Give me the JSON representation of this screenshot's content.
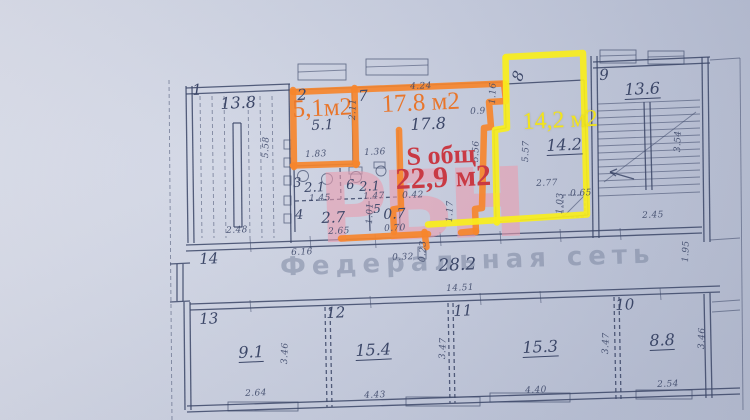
{
  "document": {
    "type": "floor-plan-photo",
    "description": "Photographed BTI floor plan with highlighted apartments"
  },
  "colors": {
    "orange_highlight": "#f6862d",
    "yellow_highlight": "#f8ee1c",
    "orange_text": "#e8762c",
    "yellow_text": "#f2e41c",
    "red_text": "#c93a44",
    "ink": "#3c4768"
  },
  "watermarks": {
    "pink": "РБН",
    "gray": "Федеральная сеть"
  },
  "highlighted": {
    "orange_rooms": [
      "2",
      "7"
    ],
    "orange_areas": [
      "5,1м2",
      "17.8 м2"
    ],
    "orange_total": "S общ 22,9 м2",
    "yellow_room": "8",
    "yellow_area": "14,2 м2"
  },
  "rooms": [
    {
      "number": "1",
      "value": "13.8"
    },
    {
      "number": "2",
      "value": "5.1"
    },
    {
      "number": "3",
      "value": "2.1"
    },
    {
      "number": "4",
      "value": "2.7"
    },
    {
      "number": "5",
      "value": "0.7"
    },
    {
      "number": "6",
      "value": "2.1"
    },
    {
      "number": "7",
      "value": "17.8"
    },
    {
      "number": "8",
      "value": "14.2"
    },
    {
      "number": "9",
      "value": "13.6"
    },
    {
      "number": "10",
      "value": "8.8"
    },
    {
      "number": "11",
      "value": "15.3"
    },
    {
      "number": "12",
      "value": "15.4"
    },
    {
      "number": "13",
      "value": "9.1"
    },
    {
      "number": "14",
      "value": "28.2"
    }
  ],
  "texts": [
    {
      "name": "room1-number",
      "text": "1",
      "x": 192,
      "y": 83,
      "cls": "rm"
    },
    {
      "name": "room1-value",
      "text": "13.8",
      "x": 220,
      "y": 96,
      "cls": "val16"
    },
    {
      "name": "dim-2-48",
      "text": "2.48",
      "x": 226,
      "y": 227,
      "cls": "dim"
    },
    {
      "name": "dim-5-58",
      "text": "5.58",
      "x": 262,
      "y": 158,
      "cls": "dim",
      "rot": -88
    },
    {
      "name": "room2-number",
      "text": "2",
      "x": 297,
      "y": 88,
      "cls": "rm"
    },
    {
      "name": "room2-area-label",
      "text": "5,1м2",
      "x": 292,
      "y": 97,
      "cls": "olabel"
    },
    {
      "name": "room2-value",
      "text": "5.1",
      "x": 311,
      "y": 119,
      "cls": "val14"
    },
    {
      "name": "dim-1-83",
      "text": "1.83",
      "x": 305,
      "y": 151,
      "cls": "dim"
    },
    {
      "name": "dim-1-36",
      "text": "1.36",
      "x": 364,
      "y": 149,
      "cls": "dim"
    },
    {
      "name": "dim-2-11",
      "text": "2.11",
      "x": 349,
      "y": 120,
      "cls": "dim",
      "rot": -88
    },
    {
      "name": "room7-number",
      "text": "7",
      "x": 358,
      "y": 89,
      "cls": "rm"
    },
    {
      "name": "room7-area-label",
      "text": "17.8 м2",
      "x": 381,
      "y": 92,
      "cls": "olabel"
    },
    {
      "name": "room7-value",
      "text": "17.8",
      "x": 410,
      "y": 117,
      "cls": "val16"
    },
    {
      "name": "dim-4-24",
      "text": "4.24",
      "x": 410,
      "y": 83,
      "cls": "dim"
    },
    {
      "name": "dim-1-16",
      "text": "1.16",
      "x": 489,
      "y": 104,
      "cls": "dim",
      "rot": -88
    },
    {
      "name": "dim-0-9",
      "text": "0.9",
      "x": 470,
      "y": 108,
      "cls": "dim"
    },
    {
      "name": "dim-5-56",
      "text": "5.56",
      "x": 472,
      "y": 162,
      "cls": "dim",
      "rot": -88
    },
    {
      "name": "room8-number",
      "text": "8",
      "x": 510,
      "y": 78,
      "cls": "rm",
      "rot": -70
    },
    {
      "name": "room8-area-label",
      "text": "14,2 м2",
      "x": 522,
      "y": 110,
      "cls": "ylabel"
    },
    {
      "name": "room8-value",
      "text": "14.2",
      "x": 546,
      "y": 138,
      "cls": "val16",
      "u": true
    },
    {
      "name": "dim-5-57",
      "text": "5.57",
      "x": 522,
      "y": 162,
      "cls": "dim",
      "rot": -88
    },
    {
      "name": "dim-2-77",
      "text": "2.77",
      "x": 536,
      "y": 180,
      "cls": "dim"
    },
    {
      "name": "dim-0-65",
      "text": "0.65",
      "x": 570,
      "y": 190,
      "cls": "dim"
    },
    {
      "name": "dim-1-03",
      "text": "1.03",
      "x": 556,
      "y": 214,
      "cls": "dim",
      "rot": -88
    },
    {
      "name": "room9-number",
      "text": "9",
      "x": 599,
      "y": 68,
      "cls": "rm"
    },
    {
      "name": "room9-value",
      "text": "13.6",
      "x": 624,
      "y": 82,
      "cls": "val16",
      "u": true
    },
    {
      "name": "dim-3-54",
      "text": "3.54",
      "x": 674,
      "y": 152,
      "cls": "dim",
      "rot": -88
    },
    {
      "name": "dim-2-45",
      "text": "2.45",
      "x": 642,
      "y": 212,
      "cls": "dim"
    },
    {
      "name": "room3-number",
      "text": "3",
      "x": 293,
      "y": 177,
      "cls": "rm13"
    },
    {
      "name": "room3-value",
      "text": "2.1",
      "x": 304,
      "y": 182,
      "cls": "val13"
    },
    {
      "name": "dim-1-45",
      "text": "1.45",
      "x": 309,
      "y": 195,
      "cls": "dim"
    },
    {
      "name": "room6-number",
      "text": "6",
      "x": 346,
      "y": 179,
      "cls": "rm13"
    },
    {
      "name": "room6-value",
      "text": "2.1",
      "x": 359,
      "y": 181,
      "cls": "val13"
    },
    {
      "name": "dim-1-47",
      "text": "1.47",
      "x": 363,
      "y": 193,
      "cls": "dim"
    },
    {
      "name": "room4-number",
      "text": "4",
      "x": 295,
      "y": 209,
      "cls": "rm13"
    },
    {
      "name": "room4-value",
      "text": "2.7",
      "x": 321,
      "y": 211,
      "cls": "val15"
    },
    {
      "name": "dim-2-65",
      "text": "2.65",
      "x": 328,
      "y": 228,
      "cls": "dim"
    },
    {
      "name": "room5-number",
      "text": "5",
      "x": 373,
      "y": 203,
      "cls": "rm12"
    },
    {
      "name": "room5-value",
      "text": "0.7",
      "x": 383,
      "y": 208,
      "cls": "val14"
    },
    {
      "name": "dim-0-70",
      "text": "0.70",
      "x": 384,
      "y": 225,
      "cls": "dim"
    },
    {
      "name": "dim-1-01",
      "text": "1.01",
      "x": 366,
      "y": 224,
      "cls": "dim",
      "rot": -88
    },
    {
      "name": "dim-0-42",
      "text": "0.42",
      "x": 402,
      "y": 192,
      "cls": "dim"
    },
    {
      "name": "dim-1-17",
      "text": "1.17",
      "x": 446,
      "y": 222,
      "cls": "dim",
      "rot": -88
    },
    {
      "name": "total-area-line1",
      "text": "S общ",
      "x": 406,
      "y": 144,
      "cls": "rl1"
    },
    {
      "name": "total-area-line2",
      "text": "22,9 м2",
      "x": 395,
      "y": 165,
      "cls": "rl2"
    },
    {
      "name": "room14-number",
      "text": "14",
      "x": 199,
      "y": 252,
      "cls": "rm15"
    },
    {
      "name": "dim-6-16",
      "text": "6.16",
      "x": 291,
      "y": 249,
      "cls": "dim"
    },
    {
      "name": "dim-0-32",
      "text": "0.32",
      "x": 392,
      "y": 254,
      "cls": "dim"
    },
    {
      "name": "dim-0-23",
      "text": "0.23",
      "x": 419,
      "y": 262,
      "cls": "dim",
      "rot": -88
    },
    {
      "name": "room14-value",
      "text": "28.2",
      "x": 438,
      "y": 258,
      "cls": "val17"
    },
    {
      "name": "dim-14-51",
      "text": "14.51",
      "x": 446,
      "y": 285,
      "cls": "dim"
    },
    {
      "name": "dim-1-95",
      "text": "1.95",
      "x": 682,
      "y": 262,
      "cls": "dim",
      "rot": -88
    },
    {
      "name": "room13-number",
      "text": "13",
      "x": 199,
      "y": 312,
      "cls": "rm15"
    },
    {
      "name": "room13-value",
      "text": "9.1",
      "x": 238,
      "y": 345,
      "cls": "val16",
      "u": true
    },
    {
      "name": "dim-2-64",
      "text": "2.64",
      "x": 245,
      "y": 390,
      "cls": "dim"
    },
    {
      "name": "dim-3-46-a",
      "text": "3.46",
      "x": 281,
      "y": 364,
      "cls": "dim",
      "rot": -88
    },
    {
      "name": "room12-number",
      "text": "12",
      "x": 326,
      "y": 306,
      "cls": "rm15"
    },
    {
      "name": "room12-value",
      "text": "15.4",
      "x": 355,
      "y": 343,
      "cls": "val16",
      "u": true
    },
    {
      "name": "dim-4-43",
      "text": "4.43",
      "x": 364,
      "y": 392,
      "cls": "dim"
    },
    {
      "name": "dim-3-47-a",
      "text": "3.47",
      "x": 439,
      "y": 359,
      "cls": "dim",
      "rot": -88
    },
    {
      "name": "room11-number",
      "text": "11",
      "x": 453,
      "y": 304,
      "cls": "rm15"
    },
    {
      "name": "room11-value",
      "text": "15.3",
      "x": 522,
      "y": 340,
      "cls": "val16",
      "u": true
    },
    {
      "name": "dim-4-40",
      "text": "4.40",
      "x": 525,
      "y": 387,
      "cls": "dim"
    },
    {
      "name": "dim-3-47-b",
      "text": "3.47",
      "x": 602,
      "y": 354,
      "cls": "dim",
      "rot": -88
    },
    {
      "name": "room10-number",
      "text": "10",
      "x": 615,
      "y": 298,
      "cls": "rm15"
    },
    {
      "name": "room10-value",
      "text": "8.8",
      "x": 649,
      "y": 333,
      "cls": "val16",
      "u": true
    },
    {
      "name": "dim-2-54",
      "text": "2.54",
      "x": 657,
      "y": 381,
      "cls": "dim"
    },
    {
      "name": "dim-3-46-b",
      "text": "3.46",
      "x": 698,
      "y": 349,
      "cls": "dim",
      "rot": -88
    }
  ]
}
